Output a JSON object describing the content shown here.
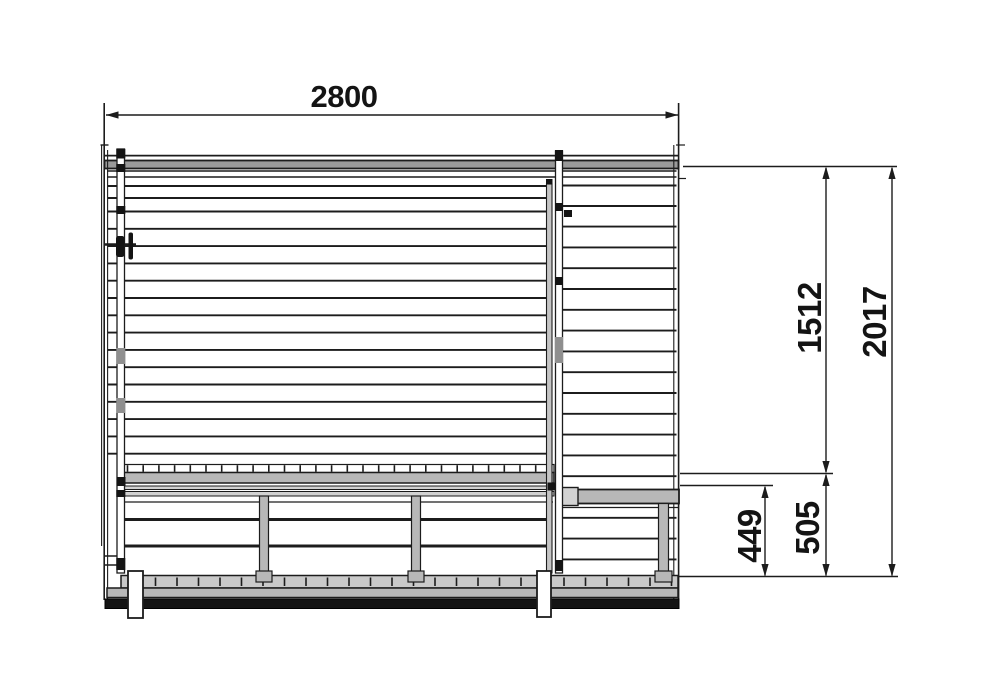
{
  "dimensions": {
    "width": "2800",
    "height_upper": "1512",
    "height_total": "2017",
    "bench_height": "449",
    "railing_height": "505"
  },
  "colors": {
    "line": "#1c1c1c",
    "dark": "#141414",
    "gray": "#b8b8b8",
    "light_gray": "#d2d2d2",
    "deck_gray": "#c9c9c9",
    "fascia_gray": "#9a9a9a",
    "background": "#ffffff"
  }
}
